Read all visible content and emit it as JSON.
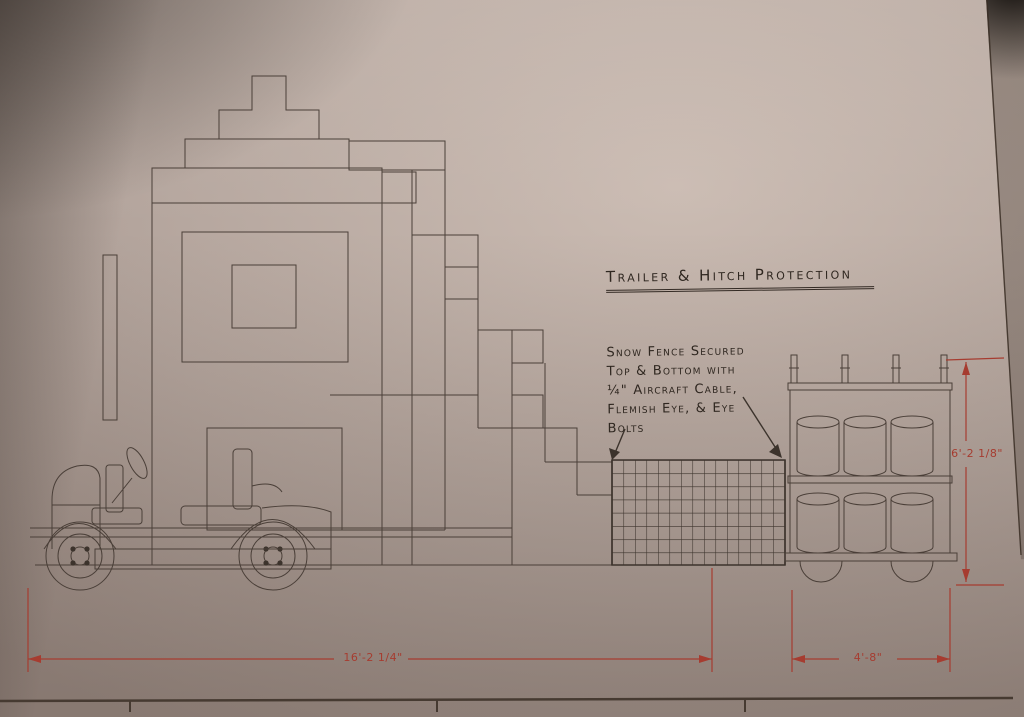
{
  "annotations": {
    "title": "Trailer & Hitch Protection",
    "note": {
      "lines": [
        "Snow Fence Secured",
        "Top & Bottom with",
        "¼\" Aircraft Cable,",
        "Flemish Eye, & Eye",
        "Bolts"
      ]
    }
  },
  "dimensions": {
    "overall_length": "16'-2 1/4\"",
    "trailer_length": "4'-8\"",
    "trailer_height": "6'-2 1/8\""
  },
  "drawing": {
    "elements": [
      "castle float structure",
      "golf cart",
      "snow fence panel",
      "barrel trailer"
    ],
    "barrels": {
      "rows": 2,
      "per_row": 3
    },
    "colors": {
      "paper": "#b7a8a0",
      "ink": "#4a3f38",
      "dimension_red": "#a63c30",
      "handwriting": "#2f2720"
    }
  }
}
